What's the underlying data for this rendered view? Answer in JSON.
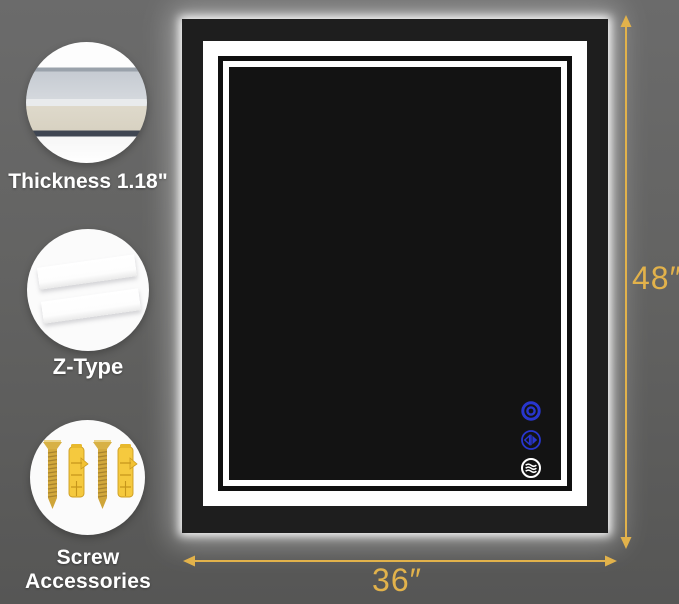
{
  "features": [
    {
      "id": "thickness",
      "label": "Thickness 1.18\""
    },
    {
      "id": "z_type",
      "label": "Z-Type"
    },
    {
      "id": "screw_accessories",
      "label": "Screw Accessories"
    }
  ],
  "dimensions": {
    "height_label": "48″",
    "width_label": "36″"
  },
  "touch_controls": [
    {
      "id": "light_power",
      "icon": "power-icon",
      "color": "#2836ce"
    },
    {
      "id": "dimmer",
      "icon": "dimmer-icon",
      "color": "#2836ce"
    },
    {
      "id": "defogger",
      "icon": "defog-icon",
      "color": "#ffffff"
    }
  ],
  "colors": {
    "background_gray": "#616161",
    "dimension_gold": "#e2b24b",
    "button_blue": "#2836ce",
    "mirror_black": "#1a1a1a",
    "led_white": "#ffffff",
    "screw_gold": "#d2a83c",
    "anchor_yellow": "#f5c93e"
  }
}
